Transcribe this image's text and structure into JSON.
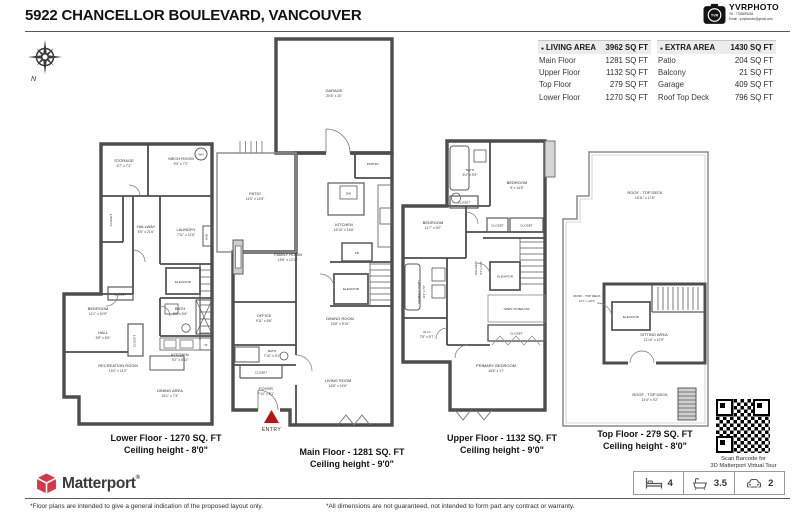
{
  "header": {
    "title": "5922 CHANCELLOR BOULEVARD, VANCOUVER",
    "vendor": {
      "name": "YVRPHOTO",
      "tel": "Tel : 7788693084",
      "email": "Email : yvrphotobc@gmail.com",
      "badge": "YVR"
    }
  },
  "compass": {
    "n": "N"
  },
  "tables": {
    "living": {
      "bullet": "●",
      "header": "LIVING AREA",
      "total": "3962 SQ FT",
      "rows": [
        {
          "label": "Main Floor",
          "value": "1281 SQ FT"
        },
        {
          "label": "Upper Floor",
          "value": "1132 SQ FT"
        },
        {
          "label": "Top Floor",
          "value": "279 SQ FT"
        },
        {
          "label": "Lower Floor",
          "value": "1270 SQ FT"
        }
      ]
    },
    "extra": {
      "bullet": "●",
      "header": "EXTRA AREA",
      "total": "1430 SQ FT",
      "rows": [
        {
          "label": "Patio",
          "value": "204 SQ FT"
        },
        {
          "label": "Balcony",
          "value": "21 SQ FT"
        },
        {
          "label": "Garage",
          "value": "409 SQ FT"
        },
        {
          "label": "Roof Top Deck",
          "value": "796 SQ FT"
        }
      ]
    }
  },
  "floors": {
    "lower": {
      "caption": "Lower Floor - 1270 SQ. FT",
      "ceiling": "Ceiling height - 8'0\"",
      "rooms": [
        {
          "name": "STORAGE",
          "dims": "6'7\" x 7'2\""
        },
        {
          "name": "MECH ROOM",
          "dims": "9'5\" x 7'2\""
        },
        {
          "name": "CLOSET",
          "dims": ""
        },
        {
          "name": "LAUNDRY",
          "dims": "7'11\" x 12'6\""
        },
        {
          "name": "HALLWAY",
          "dims": "5'5\" x 21'6\""
        },
        {
          "name": "CLOSET",
          "dims": ""
        },
        {
          "name": "BEDROOM",
          "dims": "11'1\" x 10'9\""
        },
        {
          "name": "ELEVATOR",
          "dims": ""
        },
        {
          "name": "BATH",
          "dims": "8'9\" x 5'6\""
        },
        {
          "name": "HALL",
          "dims": "5'9\" x 6'6\""
        },
        {
          "name": "CLOSET",
          "dims": ""
        },
        {
          "name": "KITCHEN",
          "dims": "9'2\" x 8'11\""
        },
        {
          "name": "RECREATION ROOM",
          "dims": "15'2\" x 11'2\""
        },
        {
          "name": "DINING AREA",
          "dims": "16'1\" x 7'3\""
        },
        {
          "name": "WH",
          "dims": ""
        },
        {
          "name": "W/D",
          "dims": ""
        },
        {
          "name": "W",
          "dims": ""
        }
      ]
    },
    "main": {
      "caption": "Main Floor - 1281 SQ. FT",
      "ceiling": "Ceiling height - 9'0\"",
      "rooms": [
        {
          "name": "GARAGE",
          "dims": "20'6\" x 20'"
        },
        {
          "name": "PATIO",
          "dims": "14'5\" x 14'5\""
        },
        {
          "name": "PANTRY",
          "dims": ""
        },
        {
          "name": "KITCHEN",
          "dims": "16'10\" x 16'6\""
        },
        {
          "name": "FR",
          "dims": ""
        },
        {
          "name": "FAMILY ROOM",
          "dims": "15'5\" x 12'11\""
        },
        {
          "name": "ELEVATOR",
          "dims": ""
        },
        {
          "name": "OFFICE",
          "dims": "9'11\" x 8'6\""
        },
        {
          "name": "DINING ROOM",
          "dims": "16'6\" x 8'10\""
        },
        {
          "name": "BATH",
          "dims": "7'10\" x 5'1\""
        },
        {
          "name": "CLOSET",
          "dims": ""
        },
        {
          "name": "FOYER",
          "dims": "7'10\" x 5'1\""
        },
        {
          "name": "LIVING ROOM",
          "dims": "16'6\" x 14'6\""
        },
        {
          "name": "DW",
          "dims": ""
        }
      ]
    },
    "upper": {
      "caption": "Upper Floor - 1132 SQ. FT",
      "ceiling": "Ceiling height - 9'0\"",
      "rooms": [
        {
          "name": "BATH",
          "dims": "5'4\" x 9'9\""
        },
        {
          "name": "BEDROOM",
          "dims": "9' x 14'6\""
        },
        {
          "name": "CLOSET",
          "dims": ""
        },
        {
          "name": "BEDROOM",
          "dims": "11'7\" x 9'2\""
        },
        {
          "name": "CLOSET",
          "dims": ""
        },
        {
          "name": "CLOSET",
          "dims": ""
        },
        {
          "name": "HALLWAY",
          "dims": "6'4\" x 21'1\""
        },
        {
          "name": "ELEVATOR",
          "dims": ""
        },
        {
          "name": "PRIMARY BATH",
          "dims": "11'1\" x 7'6\""
        },
        {
          "name": "W.I.C",
          "dims": "7'8\" x 5'7\""
        },
        {
          "name": "OPEN TO BELOW",
          "dims": ""
        },
        {
          "name": "CLOSET",
          "dims": ""
        },
        {
          "name": "PRIMARY BEDROOM",
          "dims": "16'6\" x 17'"
        }
      ]
    },
    "top": {
      "caption": "Top Floor - 279 SQ. FT",
      "ceiling": "Ceiling height - 8'0\"",
      "rooms": [
        {
          "name": "ROOF - TOP DECK",
          "dims": "16'11\" x 17'8\""
        },
        {
          "name": "ROOF - TOP DECK",
          "dims": "14'7\" x 26'2\""
        },
        {
          "name": "ELEVATOR",
          "dims": ""
        },
        {
          "name": "SITTING AREA",
          "dims": "11'10\" x 12'9\""
        },
        {
          "name": "ROOF - TOP DECK",
          "dims": "14'4\" x 9'2\""
        }
      ]
    }
  },
  "entry": {
    "label": "ENTRY"
  },
  "qr": {
    "line1": "Scan Barcode for",
    "line2": "3D Matterport Virtual Tour"
  },
  "footer": {
    "brand": "Matterport",
    "reg": "®",
    "stats": {
      "beds": "4",
      "baths": "3.5",
      "cars": "2"
    },
    "note_left": "*Floor plans are intended to give a general indication of the proposed layout only.",
    "note_right": "*All dimensions are not guaranteed, not intended to form part any contract or warranty."
  }
}
